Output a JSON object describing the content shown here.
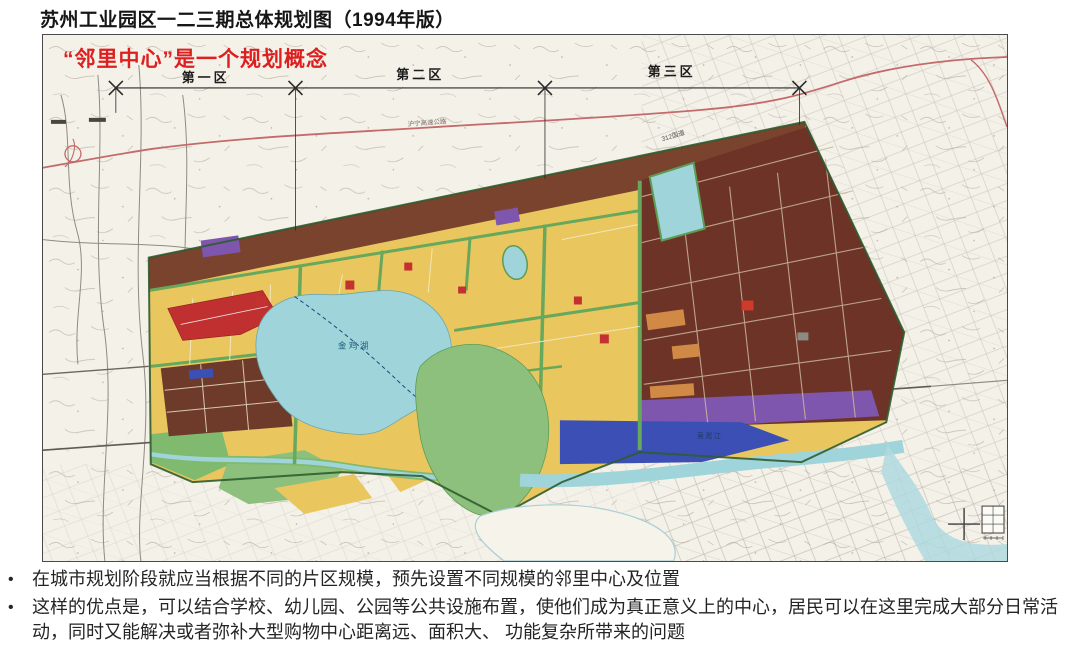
{
  "page": {
    "title": "苏州工业园区一二三期总体规划图（1994年版）"
  },
  "map": {
    "annotation": "“邻里中心”是一个规划概念",
    "district_labels": [
      "第一区",
      "第二区",
      "第三区"
    ],
    "labels": {
      "expressway": "沪宁高速公路",
      "national_road": "312国道",
      "lake": "金鸡湖",
      "river": "吴淞江"
    },
    "colors": {
      "annotation_red": "#dd1f1f",
      "residential_yellow": "#e9c75e",
      "industrial_maroon": "#6d3326",
      "industrial_brown_band": "#7a432e",
      "water_cyan": "#9ed4da",
      "green_space": "#8cc07c",
      "road_green": "#67a85c",
      "purple_zone": "#7f56ad",
      "blue_zone": "#3c4fb4",
      "center_red": "#c13030",
      "highway_line_red": "#c46a6a"
    }
  },
  "bullets": {
    "marker": "•",
    "items": [
      "在城市规划阶段就应当根据不同的片区规模，预先设置不同规模的邻里中心及位置",
      "这样的优点是，可以结合学校、幼儿园、公园等公共设施布置，使他们成为真正意义上的中心，居民可以在这里完成大部分日常活动，同时又能解决或者弥补大型购物中心距离远、面积大、 功能复杂所带来的问题"
    ]
  }
}
